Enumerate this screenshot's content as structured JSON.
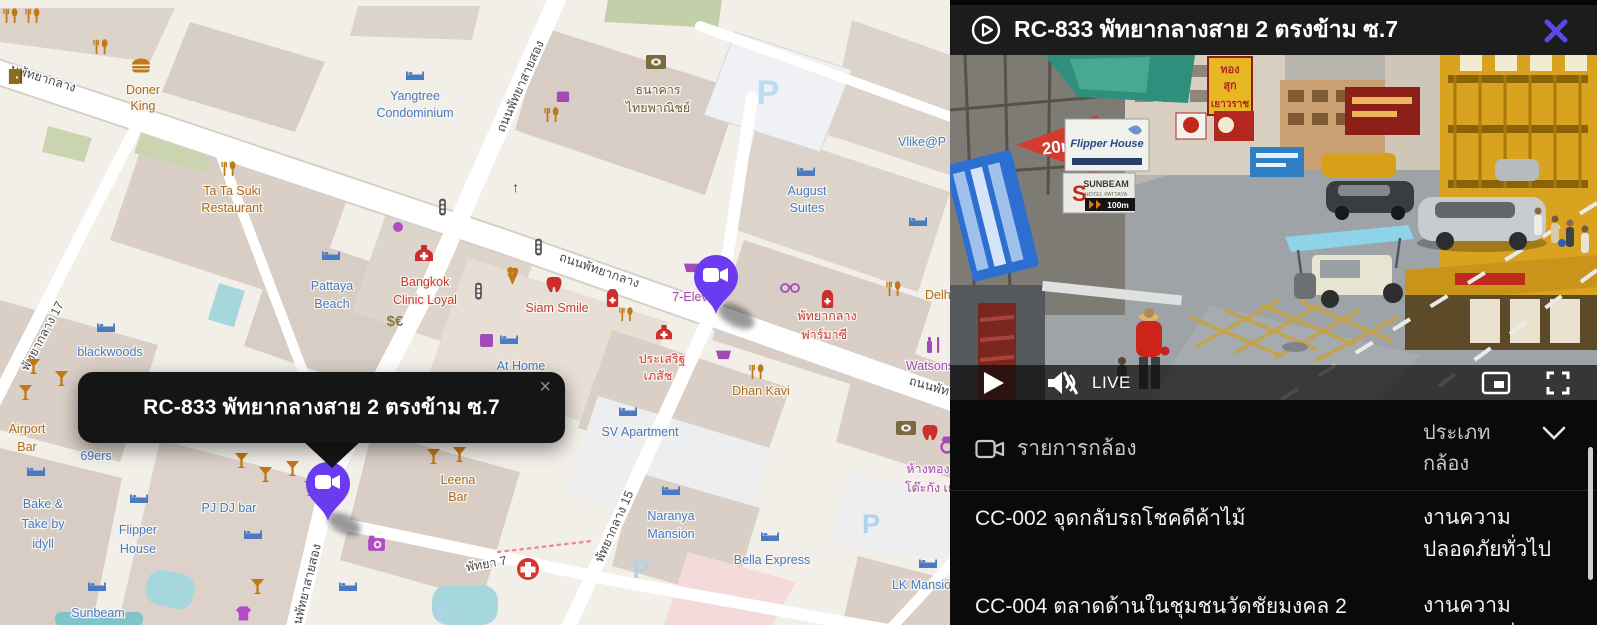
{
  "colors": {
    "accent_purple": "#5a49e6",
    "marker_purple": "#6a3bf0",
    "panel_bg": "#0b0b0b",
    "map_bg": "#f2efe9",
    "live_red_sign": "#d33b2f"
  },
  "map": {
    "popup": {
      "title": "RC-833 พัทยากลางสาย 2 ตรงข้าม ซ.7",
      "close": "×"
    },
    "parking": "P",
    "streets": {
      "pattaya_klang_left": "นพัทยากลาง",
      "pattaya_klang": "ถนนพัทยากลาง",
      "pattaya_klang_right": "ถนนพัท",
      "second_road_top": "ถนนพัทยาสายสอง",
      "second_road_bottom": "ถนนพัทยาสายสอง",
      "soi17": "พัทยากลาง 17",
      "soi15": "พัทยากลาง 15",
      "pattaya7": "พัทยา 7"
    },
    "pois": {
      "doner": {
        "l1": "Doner",
        "l2": "King"
      },
      "yangtree": {
        "l1": "Yangtree",
        "l2": "Condominium"
      },
      "scb": {
        "l1": "ธนาคาร",
        "l2": "ไทยพาณิชย์"
      },
      "vlike": {
        "l1": "Vlike@P"
      },
      "tata": {
        "l1": "Ta Ta Suki",
        "l2": "Restaurant"
      },
      "pattaya_beach": {
        "l1": "Pattaya",
        "l2": "Beach"
      },
      "bangkok_clinic": {
        "l1": "Bangkok",
        "l2": "Clinic Loyal"
      },
      "exchange": {
        "l1": "$€"
      },
      "siam_smile": {
        "l1": "Siam Smile"
      },
      "seven_eleven": {
        "l1": "7-Elev"
      },
      "august": {
        "l1": "August",
        "l2": "Suites"
      },
      "delhi": {
        "l1": "Delhi D"
      },
      "prasert": {
        "l1": "ประเสริฐ",
        "l2": "เภสัช"
      },
      "pharmacy": {
        "l1": "พัทยากลาง",
        "l2": "ฟาร์มาซี"
      },
      "dhan_kavi": {
        "l1": "Dhan Kavi"
      },
      "watsons": {
        "l1": "Watsons"
      },
      "hangtong": {
        "l1": "ห้างทอง",
        "l2": "โต๊ะกัง เย"
      },
      "at_home": {
        "l1": "At Home"
      },
      "blackwoods": {
        "l1": "blackwoods"
      },
      "airport_bar": {
        "l1": "Airport",
        "l2": "Bar"
      },
      "sixty9ers": {
        "l1": "69ers"
      },
      "bake": {
        "l1": "Bake &",
        "l2": "Take by",
        "l3": "idyll"
      },
      "flipper": {
        "l1": "Flipper",
        "l2": "House"
      },
      "pjdj": {
        "l1": "PJ DJ bar"
      },
      "sunbeam": {
        "l1": "Sunbeam"
      },
      "leena": {
        "l1": "Leena",
        "l2": "Bar"
      },
      "sv_apartment": {
        "l1": "SV Apartment"
      },
      "naranya": {
        "l1": "Naranya",
        "l2": "Mansion"
      },
      "bella": {
        "l1": "Bella Express"
      },
      "lk_mansion": {
        "l1": "LK Mansion"
      }
    }
  },
  "panel": {
    "header": {
      "title": "RC-833 พัทยากลางสาย 2 ตรงข้าม ซ.7"
    },
    "video": {
      "signs": {
        "distance": "20m.",
        "flipper": "Flipper House",
        "sunbeam": "SUNBEAM",
        "sunbeam_sub": "HOTEL PATTAYA",
        "sunbeam_dist": "100m",
        "gold1": "ทอง",
        "gold2": "สุก",
        "gold3": "เยาวราช"
      },
      "controls": {
        "live": "LIVE"
      }
    },
    "camera_list": {
      "title": "รายการกล้อง",
      "type_header_l1": "ประเภท",
      "type_header_l2": "กล้อง",
      "rows": [
        {
          "name": "CC-002 จุดกลับรถโชคดีค้าไม้",
          "type_l1": "งานความ",
          "type_l2": "ปลอดภัยทั่วไป"
        },
        {
          "name": "CC-004 ตลาดด้านในชุมชนวัดชัยมงคล 2",
          "type_l1": "งานความ",
          "type_l2": "ปลอดภัยทั่วไป"
        }
      ]
    }
  }
}
